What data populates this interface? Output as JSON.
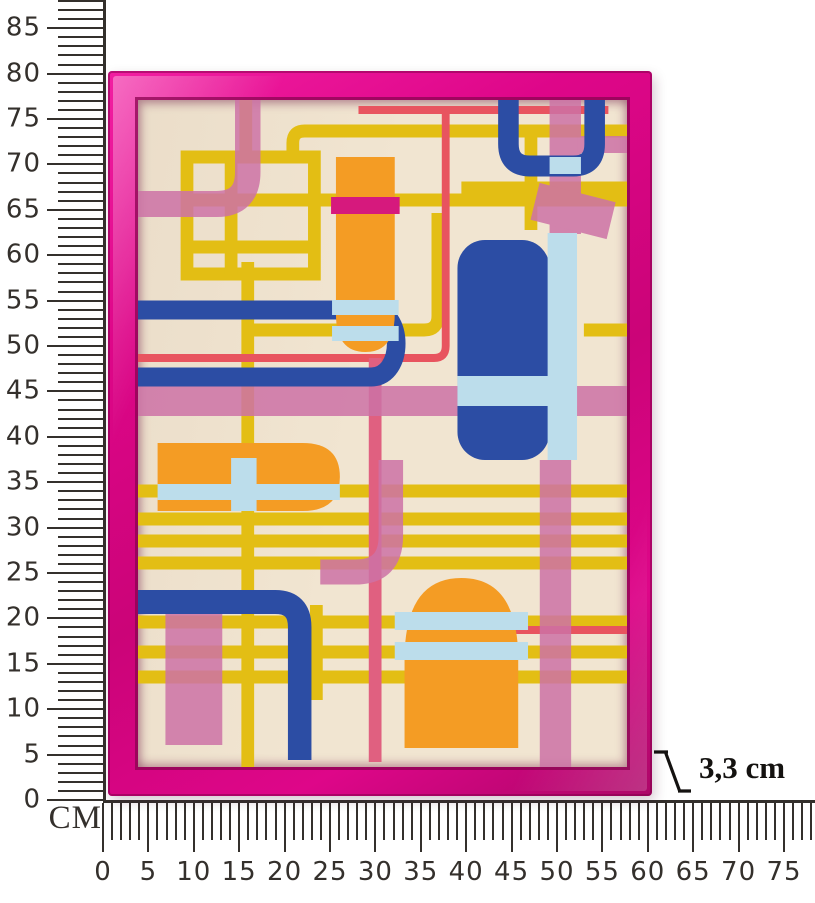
{
  "product": {
    "description": "Framed abstract geometric artwork measured against centimetre rulers",
    "width_cm_on_ruler": 60,
    "height_cm_on_ruler": 80
  },
  "rulers": {
    "unit_label": "CM",
    "vertical": {
      "labels": [
        "0",
        "5",
        "10",
        "15",
        "20",
        "25",
        "30",
        "35",
        "40",
        "45",
        "50",
        "55",
        "60",
        "65",
        "70",
        "75",
        "80",
        "85"
      ],
      "minor_step_cm": 1,
      "major_step_cm": 5,
      "visible_span_cm": 88
    },
    "horizontal": {
      "labels": [
        "0",
        "5",
        "10",
        "15",
        "20",
        "25",
        "30",
        "35",
        "40",
        "45",
        "50",
        "55",
        "60",
        "65",
        "70",
        "75"
      ],
      "minor_step_cm": 1,
      "major_step_cm": 5,
      "visible_span_cm": 78
    }
  },
  "annotation": {
    "depth_value": "3,3 cm"
  },
  "palette": {
    "frame_pink": "#DE0689",
    "canvas_cream": "#F1E5D1",
    "art_yellow": "#E3BE14",
    "art_mauve": "#CD72A6",
    "art_hot_pink": "#D6197D",
    "art_red": "#E8545F",
    "art_blue": "#2C4DA4",
    "art_light_blue": "#BCDDEB",
    "art_orange": "#F49C24",
    "ruler_ink": "#34302C"
  }
}
